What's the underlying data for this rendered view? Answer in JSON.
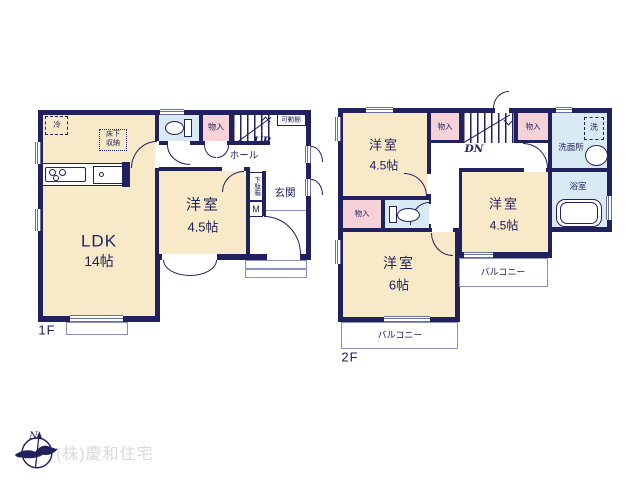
{
  "colors": {
    "wall": "#21215e",
    "cream": "#f8e9c9",
    "pink": "#f6d2d8",
    "blue": "#d9eaf5",
    "line": "#8b90bf",
    "winline": "#6a6fa0",
    "company": "#d9d9d9"
  },
  "f1": {
    "floor_label": "1F",
    "ldk": {
      "name": "LDK",
      "size": "14帖"
    },
    "yoshitsu": {
      "name": "洋室",
      "size": "4.5帖"
    },
    "fridge": "冷",
    "underfloor": [
      "床下",
      "収納"
    ],
    "monoire": "物入",
    "kadodana": "可動棚",
    "hall": "ホール",
    "stairs_dir": "UP",
    "genkan": "玄関",
    "getabako": "下駄箱",
    "meterbox": "M"
  },
  "f2": {
    "floor_label": "2F",
    "rooms": {
      "nw": {
        "name": "洋室",
        "size": "4.5帖"
      },
      "e": {
        "name": "洋室",
        "size": "4.5帖"
      },
      "sw": {
        "name": "洋室",
        "size": "6帖"
      }
    },
    "monoire_top1": "物入",
    "monoire_top2": "物入",
    "monoire_sw": "物入",
    "stairs_dir": "DN",
    "senmenjo": "洗面所",
    "laundry": "洗",
    "bathroom": "浴室",
    "balcony_e": "バルコニー",
    "balcony_s": "バルコニー"
  },
  "footer": {
    "company": "(株)慶和住宅",
    "compass_n": "N"
  }
}
